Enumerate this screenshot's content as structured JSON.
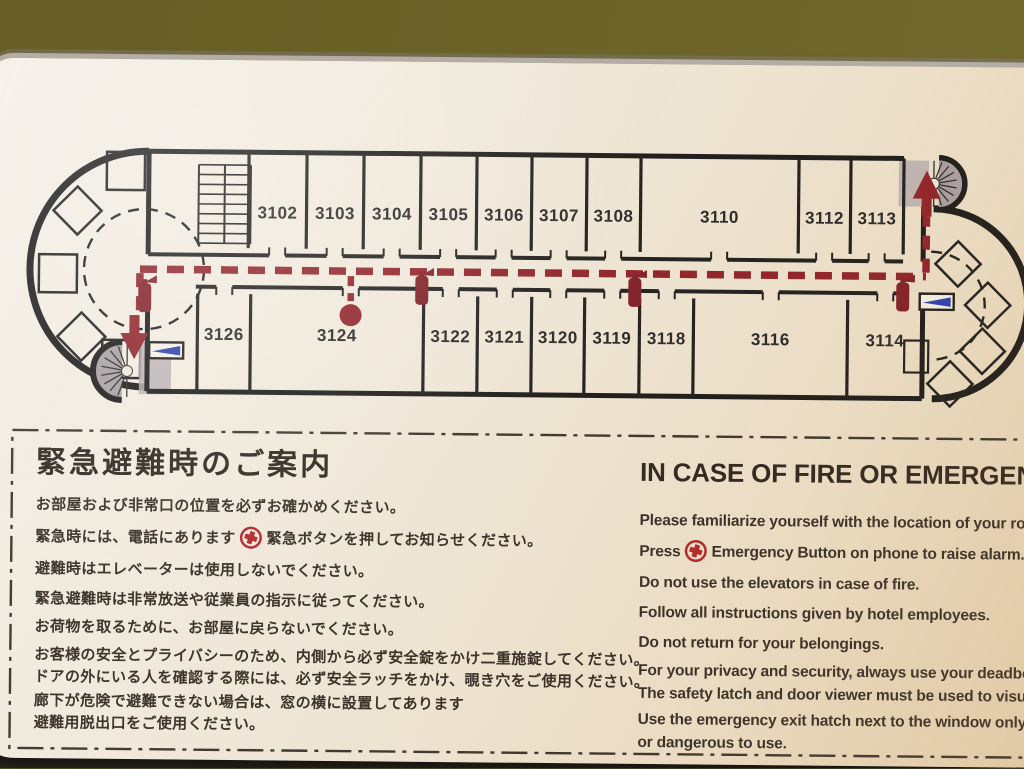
{
  "sign": {
    "jp": {
      "heading": "緊急避難時のご案内",
      "lines": [
        {
          "text": "お部屋および非常口の位置を必ずお確かめください。"
        },
        {
          "pre": "緊急時には、電話にあります",
          "icon": "emergency-button-icon",
          "post": "緊急ボタンを押してお知らせください。"
        },
        {
          "text": "避難時はエレベーターは使用しないでください。"
        },
        {
          "text": "緊急避難時は非常放送や従業員の指示に従ってください。"
        },
        {
          "text": "お荷物を取るために、お部屋に戻らないでください。"
        },
        {
          "text": "お客様の安全とプライバシーのため、内側から必ず安全錠をかけ二重施錠してください。"
        },
        {
          "text": "ドアの外にいる人を確認する際には、必ず安全ラッチをかけ、覗き穴をご使用ください。"
        },
        {
          "text": "廊下が危険で避難できない場合は、窓の横に設置してあります"
        },
        {
          "text": "避難用脱出口をご使用ください。"
        }
      ]
    },
    "en": {
      "heading": "IN CASE OF FIRE OR EMERGENCY",
      "lines": [
        {
          "text": "Please familiarize yourself with the location of your ro"
        },
        {
          "pre": "Press",
          "icon": "emergency-button-icon",
          "post": "Emergency Button on phone to raise alarm."
        },
        {
          "text": "Do not use the elevators in case of fire."
        },
        {
          "text": "Follow all instructions given by hotel employees."
        },
        {
          "text": "Do not return for your belongings."
        },
        {
          "text": "For your privacy and security, always use your deadbolt t"
        },
        {
          "text": "The safety latch and door viewer must be used to visually"
        },
        {
          "text": "Use the emergency exit hatch next to the window only"
        },
        {
          "text": "or dangerous to use."
        }
      ]
    }
  },
  "floorplan": {
    "top_rooms": [
      {
        "label": "3102",
        "x1": 266,
        "x2": 324
      },
      {
        "label": "3103",
        "x1": 324,
        "x2": 381
      },
      {
        "label": "3104",
        "x1": 381,
        "x2": 438
      },
      {
        "label": "3105",
        "x1": 438,
        "x2": 494
      },
      {
        "label": "3106",
        "x1": 494,
        "x2": 549
      },
      {
        "label": "3107",
        "x1": 549,
        "x2": 604
      },
      {
        "label": "3108",
        "x1": 604,
        "x2": 658
      },
      {
        "label": "3110",
        "x1": 658,
        "x2": 816
      },
      {
        "label": "3112",
        "x1": 816,
        "x2": 868
      },
      {
        "label": "3113",
        "x1": 868,
        "x2": 921
      }
    ],
    "bottom_rooms": [
      {
        "label": "3126",
        "x1": 216,
        "x2": 269
      },
      {
        "label": "3124",
        "x1": 269,
        "x2": 442,
        "door": 369
      },
      {
        "label": "3122",
        "x1": 442,
        "x2": 496
      },
      {
        "label": "3121",
        "x1": 496,
        "x2": 550
      },
      {
        "label": "3120",
        "x1": 550,
        "x2": 603
      },
      {
        "label": "3119",
        "x1": 603,
        "x2": 658
      },
      {
        "label": "3118",
        "x1": 658,
        "x2": 712
      },
      {
        "label": "3116",
        "x1": 712,
        "x2": 866
      },
      {
        "label": "3114",
        "x1": 866,
        "x2": 941
      }
    ],
    "icons": [
      "fire-extinguisher-icon",
      "emergency-exit-flag-icon",
      "spiral-staircase-icon",
      "straight-stairs-icon",
      "current-location-marker",
      "emergency-button-icon"
    ],
    "colors": {
      "route_red": "#8e2028",
      "icon_red": "#b1252b",
      "flag_blue": "#2b3db0",
      "stair_gray": "#a79ea3",
      "line_black": "#1c1c1c",
      "label_color": "#262626",
      "panel_cream": "#f0e9dc",
      "wall_olive": "#6b6228"
    }
  }
}
